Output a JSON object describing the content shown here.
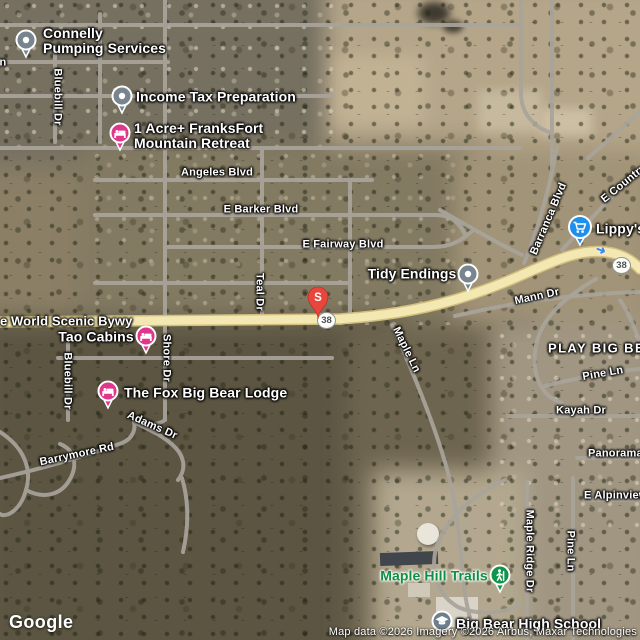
{
  "pois": {
    "connelly": {
      "line1": "Connelly",
      "line2": "Pumping Services"
    },
    "income_tax": {
      "label": "Income Tax Preparation"
    },
    "franksfort": {
      "line1": "1 Acre+ FranksFort",
      "line2": "Mountain Retreat"
    },
    "tidy_endings": {
      "label": "Tidy Endings"
    },
    "lippys": {
      "label": "Lippy's"
    },
    "tao_cabins": {
      "label": "Tao Cabins"
    },
    "fox_lodge": {
      "label": "The Fox Big Bear Lodge"
    },
    "maple_hill_trails": {
      "label": "Maple Hill Trails"
    },
    "high_school": {
      "label": "Big Bear High School"
    },
    "s_marker": {
      "letter": "S"
    }
  },
  "streets": {
    "partial_n": "n",
    "bluebill_top": "Bluebill Dr",
    "angeles": "Angeles Blvd",
    "barker": "E Barker Blvd",
    "fairway": "E Fairway Blvd",
    "teal": "Teal Dr",
    "scenic_byway": "e World Scenic Bywy",
    "shore": "Shore Dr",
    "bluebill_lower": "Bluebill Dr",
    "adams": "Adams Dr",
    "barrymore": "Barrymore Rd",
    "mann": "Mann Dr",
    "barranca": "Barranca Blvd",
    "country": "E Country",
    "maple_ln": "Maple Ln",
    "pine_upper": "Pine Ln",
    "kayah": "Kayah Dr",
    "panorama": "Panorama",
    "alpinview": "E Alpinview",
    "maple_ridge": "Maple Ridge Dr",
    "pine_lower": "Pine Ln",
    "play_big_bear": "PLAY BIG BEAR"
  },
  "route_badges": {
    "near_s": "38",
    "east": "38"
  },
  "icons": {
    "turn_arrow_glyph": "➜",
    "names": [
      "pin-icon",
      "bed-icon",
      "shopping-cart-icon",
      "graduation-cap-icon",
      "hiker-icon",
      "dot-icon"
    ]
  },
  "colors": {
    "highway_yellow": "#f3e8b2",
    "road_gray": "#a9a49b",
    "marker_pink": "#e0368c",
    "marker_blue": "#1d90ee",
    "marker_gray": "#78858f",
    "marker_green": "#10944a",
    "destination_red": "#e8463c",
    "trail_label_green": "#0e9044"
  },
  "footer": {
    "logo": "Google",
    "attribution": "Map data ©2026 Imagery ©2026 Airbus, Maxar Technologies"
  }
}
